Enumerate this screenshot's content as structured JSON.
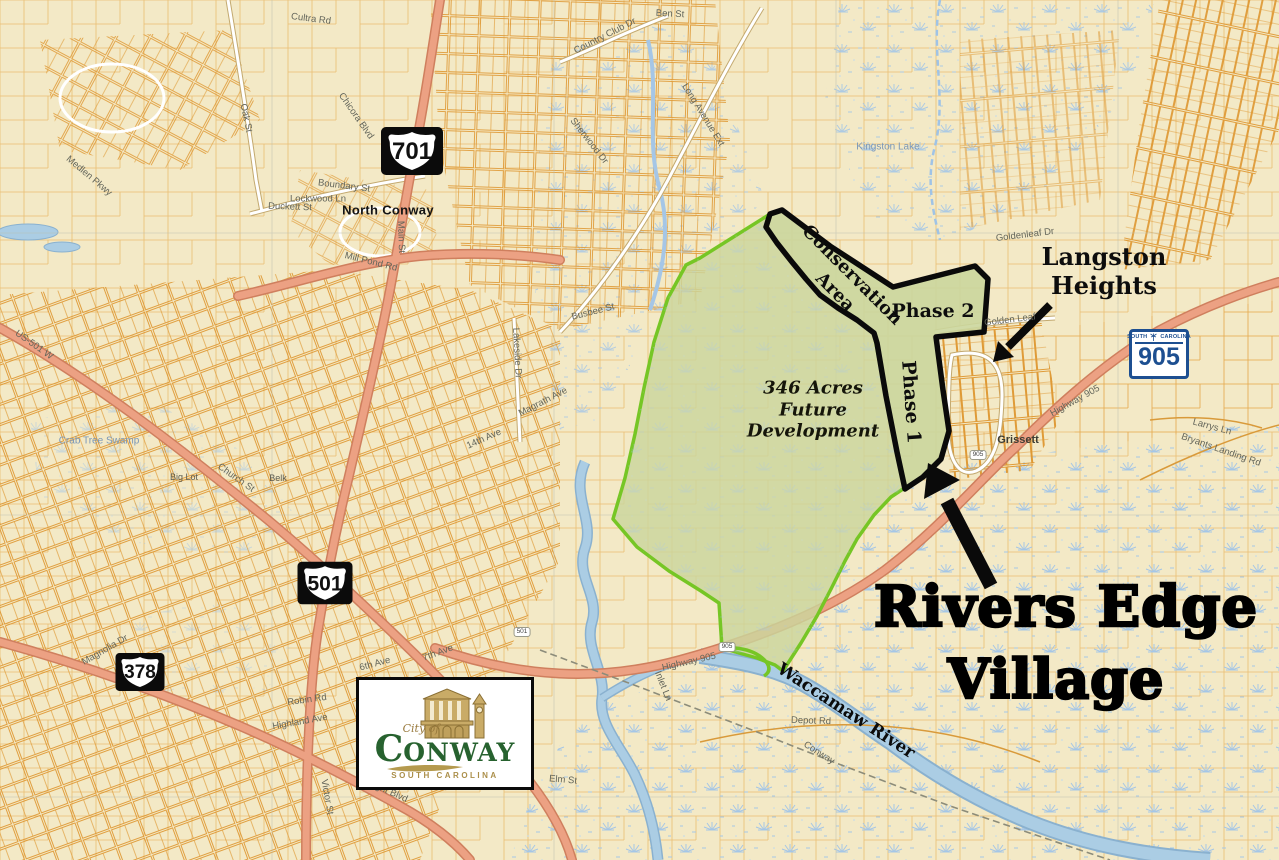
{
  "annotations": {
    "title_line1": "Rivers Edge",
    "title_line2": "Village",
    "langston_line1": "Langston",
    "langston_line2": "Heights",
    "conservation_line1": "Conservation",
    "conservation_line2": "Area",
    "phase1": "Phase 1",
    "phase2": "Phase 2",
    "acres_line1": "346 Acres",
    "acres_line2": "Future",
    "acres_line3": "Development"
  },
  "shields": {
    "us701": "701",
    "us501": "501",
    "us378": "378",
    "sc905": {
      "top_left": "SOUTH",
      "top_right": "CAROLINA",
      "number": "905"
    }
  },
  "logo": {
    "city_of": "City of",
    "initial": "C",
    "rest": "ONWAY",
    "state": "SOUTH CAROLINA"
  },
  "mini_markers": [
    {
      "text": "905"
    },
    {
      "text": "501"
    },
    {
      "text": "905"
    }
  ],
  "map_labels": [
    {
      "text": "North Conway"
    },
    {
      "text": "Grissett"
    },
    {
      "text": "Kingston Lake"
    },
    {
      "text": "Crab Tree Swamp"
    },
    {
      "text": "Big Lot"
    },
    {
      "text": "Belk"
    },
    {
      "text": "Church St"
    },
    {
      "text": "US-501 W"
    },
    {
      "text": "Mill Pond Rd"
    },
    {
      "text": "Main St"
    },
    {
      "text": "Boundary St"
    },
    {
      "text": "Duckett St"
    },
    {
      "text": "Lockwood Ln"
    },
    {
      "text": "Cultra Rd"
    },
    {
      "text": "Oak St"
    },
    {
      "text": "Chicora Blvd"
    },
    {
      "text": "Medlen Pkwy"
    },
    {
      "text": "Lakeside Dr"
    },
    {
      "text": "Magrath Ave"
    },
    {
      "text": "Busbee St"
    },
    {
      "text": "Long Avenue Ext"
    },
    {
      "text": "Sherwood Dr"
    },
    {
      "text": "Country Club Dr"
    },
    {
      "text": "Ben St"
    },
    {
      "text": "Highway 905"
    },
    {
      "text": "Inlet Ln"
    },
    {
      "text": "Depot Rd"
    },
    {
      "text": "Conway"
    },
    {
      "text": "Elm St"
    },
    {
      "text": "Golden Leaf"
    },
    {
      "text": "Goldenleaf Dr"
    },
    {
      "text": "Bryants Landing Rd"
    },
    {
      "text": "14th Ave"
    },
    {
      "text": "Larrys Ln"
    },
    {
      "text": "Highway 905"
    },
    {
      "text": "Waccamaw River"
    },
    {
      "text": "7th Ave"
    },
    {
      "text": "6th Ave"
    },
    {
      "text": "Robin Rd"
    },
    {
      "text": "Highland Ave"
    },
    {
      "text": "Wright Blvd"
    },
    {
      "text": "Victor St"
    },
    {
      "text": "Magnolia Dr"
    }
  ],
  "colors": {
    "background_cream": "#f3e9c6",
    "parcel_orange": "#e2992e",
    "highway_salmon": "#eca183",
    "development_green_outline": "#76c625",
    "development_sage_fill": "#cbd69c",
    "water_blue": "#abcde4",
    "shield_blue": "#1d4f91",
    "logo_green": "#27622f",
    "logo_gold": "#ab8f4a",
    "annotation_black": "#0d0d0d"
  }
}
